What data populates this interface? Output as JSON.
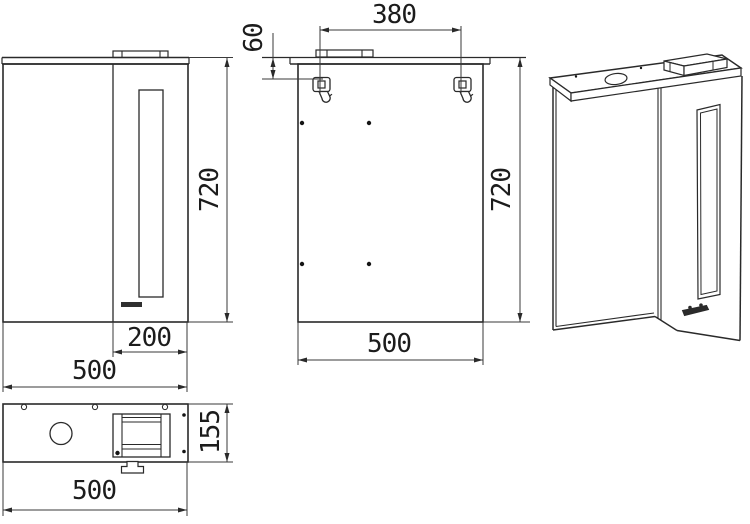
{
  "dimensions": {
    "front_view": {
      "height": "720",
      "door_width": "200",
      "width": "500"
    },
    "back_view": {
      "hanger_span": "380",
      "hanger_offset": "60",
      "height": "720",
      "width": "500"
    },
    "top_view": {
      "depth": "155",
      "width": "500"
    }
  }
}
